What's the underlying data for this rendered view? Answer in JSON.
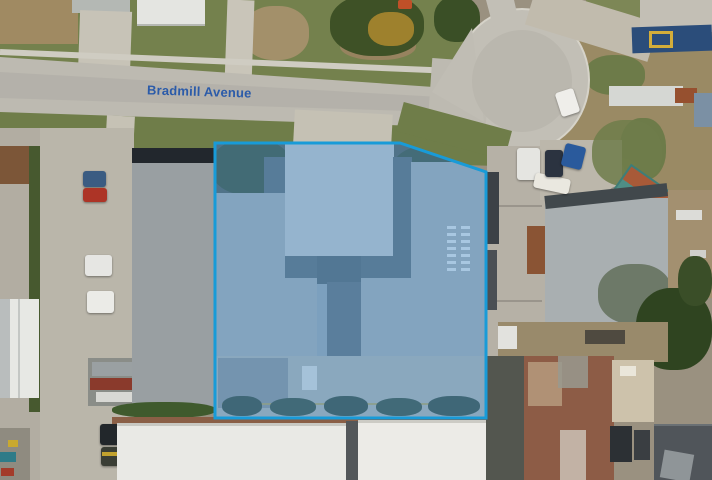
{
  "scene": {
    "type": "aerial-photo-of-industrial-property",
    "street_label": "Bradmill Avenue",
    "street_label_color": "#2b5ba9"
  },
  "highlight": {
    "points": "215,143 400,143 486,172 486,418 215,418",
    "fill": "rgba(88,152,208,0.45)",
    "stroke": "#189bd8",
    "stroke_width": "3"
  }
}
